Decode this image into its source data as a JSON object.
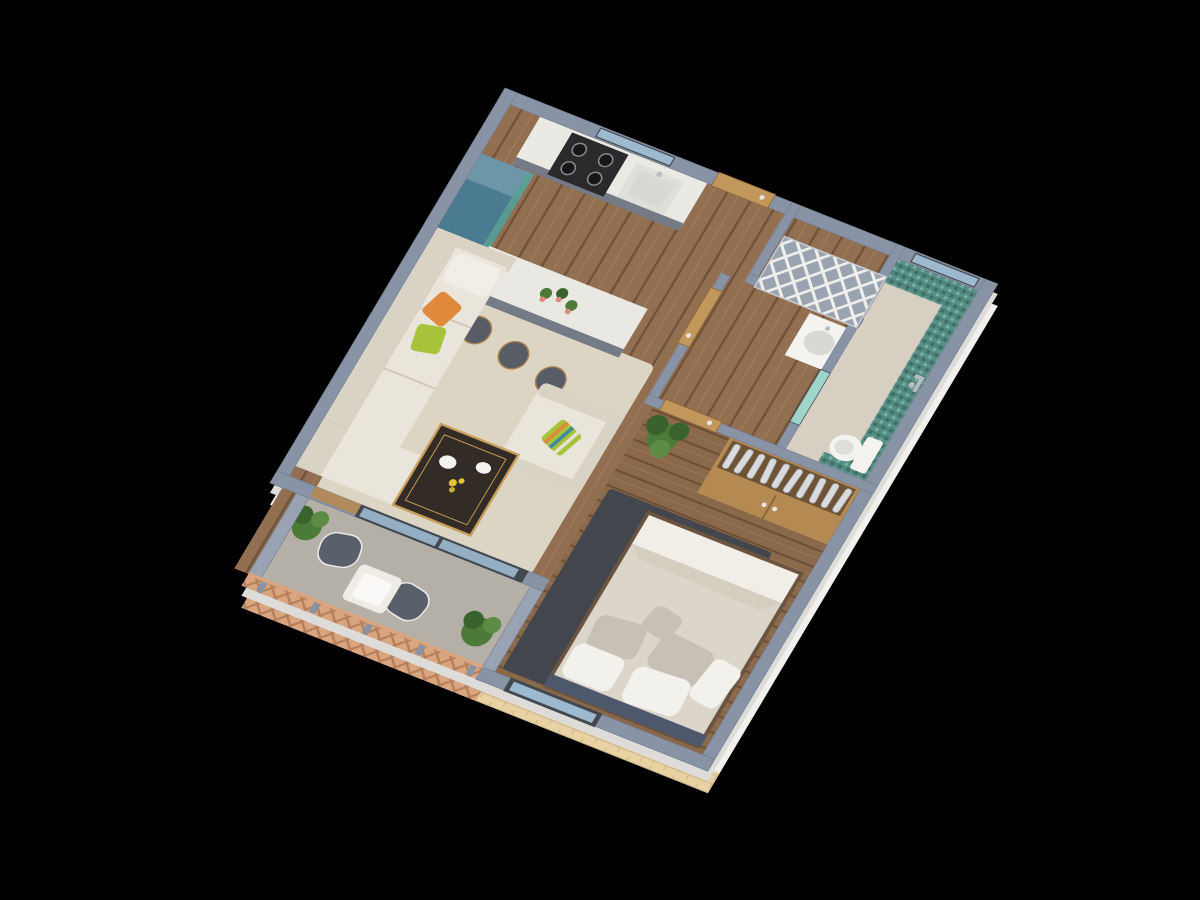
{
  "scene": {
    "title": "3D axonometric floor plan render of a one-bedroom apartment on a black background",
    "view": "top-down axonometric, plan rotated about 22 degrees",
    "background": "#000000"
  },
  "rooms": [
    {
      "id": "kitchen",
      "label": "Kitchen",
      "features": [
        "gas stove with 4 burners",
        "sink with faucet",
        "blue-teal refrigerator",
        "window over counter",
        "marble island with 3 cactus pots",
        "3 gray bar stools"
      ]
    },
    {
      "id": "living-room",
      "label": "Living room",
      "features": [
        "cream L-shaped sofa",
        "orange pillow",
        "green pillow",
        "cream armchair with striped pillow",
        "dark marble coffee table with gold trim",
        "beige rug"
      ]
    },
    {
      "id": "hallway",
      "label": "Hallway",
      "features": [
        "wood plank floor",
        "wooden entry door"
      ]
    },
    {
      "id": "utility-room",
      "label": "Utility room",
      "features": [
        "white diamond lattice screen"
      ]
    },
    {
      "id": "laundry-room",
      "label": "Laundry / WC room",
      "features": [
        "wooden door",
        "white basin unit"
      ]
    },
    {
      "id": "bathroom",
      "label": "Bathroom",
      "features": [
        "teal mosaic tile walls",
        "window",
        "toilet",
        "wall shower fixture",
        "glass door"
      ]
    },
    {
      "id": "bedroom",
      "label": "Bedroom",
      "features": [
        "double bed with beige duvet",
        "white and gray pillows",
        "navy headboard",
        "dark gray rug",
        "wardrobe with hanging clothes",
        "potted plant",
        "window with brick exterior wall"
      ]
    },
    {
      "id": "balcony",
      "label": "Balcony",
      "features": [
        "concrete floor",
        "wood lattice railing",
        "two gray chairs",
        "small white table",
        "two potted plants",
        "sliding glass doors"
      ]
    }
  ],
  "palette": {
    "background": "#000000",
    "wallTop": "#8893a5",
    "wallTopLight": "#99a3b3",
    "wallEdge": "#6f7a8d",
    "wallFace": "#f1f0ed",
    "wallFaceShade": "#dddcd8",
    "woodFloor": "#926f50",
    "woodFloorDark": "#7d5c40",
    "bedroomFloor": "#8a684a",
    "bathFloor": "#d7cfc2",
    "concrete": "#b4afa7",
    "tealTile": "#578f85",
    "tealTileDark": "#3e6e66",
    "doorWood": "#c1975c",
    "counterTop": "#eae9e4",
    "cabinetGray": "#757b86",
    "stoveDark": "#2a2a2d",
    "fridgeBlue": "#4b7b91",
    "fridgeBlueTop": "#6d97a9",
    "islandMarble": "#e9e8e3",
    "stoolGray": "#575c66",
    "stoolWood": "#a97f4e",
    "cream": "#eae5da",
    "creamShade": "#d9d3c6",
    "pillowOrange": "#e0883c",
    "pillowGreen": "#a6c33b",
    "rugLiving": "#ddd5c4",
    "tableDark": "#332b25",
    "gold": "#c79e5b",
    "rugBedroom": "#43474d",
    "duvet": "#dcd6ca",
    "sheetWhite": "#f1eee7",
    "pillowWhite": "#f3f1ec",
    "pillowGray": "#c7c0b4",
    "headboardNavy": "#4e586c",
    "bedBase": "#6b543f",
    "wardrobeWood": "#b58a52",
    "clothesSilver": "#d9dbde",
    "plantGreen": "#4c7a38",
    "plantDark": "#3a622c",
    "chairGray": "#5a6069",
    "whiteTable": "#efece5",
    "railWood": "#d9a57e",
    "brick": "#e8d2a4",
    "glassBlue": "#9db9cf",
    "glassTeal": "#9fd4cb",
    "frameDark": "#43484f",
    "latticeBack": "#9aa3b0",
    "white": "#f4f3f0",
    "basinGray": "#d9d9d3",
    "chrome": "#b9bdc2"
  }
}
